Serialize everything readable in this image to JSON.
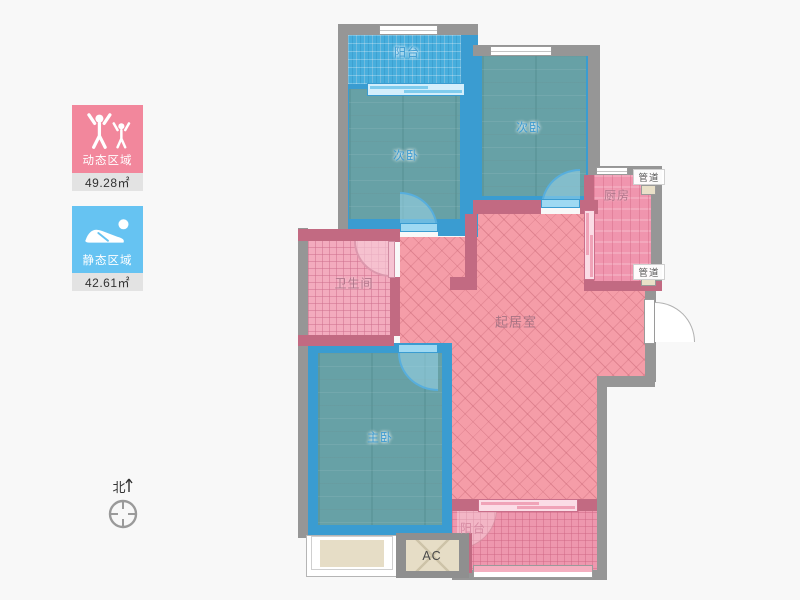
{
  "legend": {
    "dynamic": {
      "label": "动态区域",
      "area": "49.28㎡"
    },
    "static": {
      "label": "静态区域",
      "area": "42.61㎡"
    }
  },
  "compass": {
    "north": "北"
  },
  "rooms": {
    "balcony_top": "阳台",
    "bedroom_left": "次卧",
    "bedroom_right": "次卧",
    "kitchen": "厨房",
    "duct_top": "管道",
    "duct_bottom": "管道",
    "bathroom": "卫生间",
    "living_room": "起居室",
    "master_bedroom": "主卧",
    "balcony_bottom": "阳台",
    "ac_platform": "AC"
  },
  "colors": {
    "dynamic_card": "#f2879c",
    "static_card": "#66c3f2",
    "wall": "#969696",
    "room_border_blue": "#3a9cd1",
    "room_wall_pink": "#c26a82",
    "living_fill": "#f59da8"
  }
}
